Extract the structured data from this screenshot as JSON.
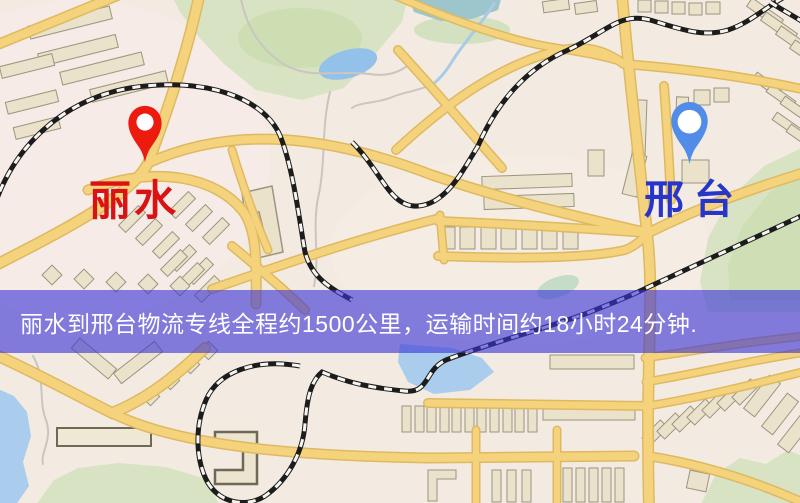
{
  "markers": {
    "origin": {
      "label": "丽水",
      "label_color": "#de1212",
      "pin_color": "#f2190e"
    },
    "destination": {
      "label": "邢台",
      "label_color": "#2635cd",
      "pin_color": "#4f8ceb"
    }
  },
  "banner": {
    "text": "丽水到邢台物流专线全程约1500公里，运输时间约18小时24分钟.",
    "background": "rgba(58,54,218,0.62)",
    "text_color": "#ffffff"
  },
  "map_palette": {
    "background": "#f3ebe1",
    "road_core": "#f6d379",
    "road_casing": "#dfb95e",
    "park_green": "#d8e3c2",
    "water_blue": "#a9cdef",
    "building_fill": "#eae2c9",
    "building_stroke": "#9b957f",
    "railway_black": "#1c1c1c",
    "railway_white": "#f7f5f0"
  }
}
